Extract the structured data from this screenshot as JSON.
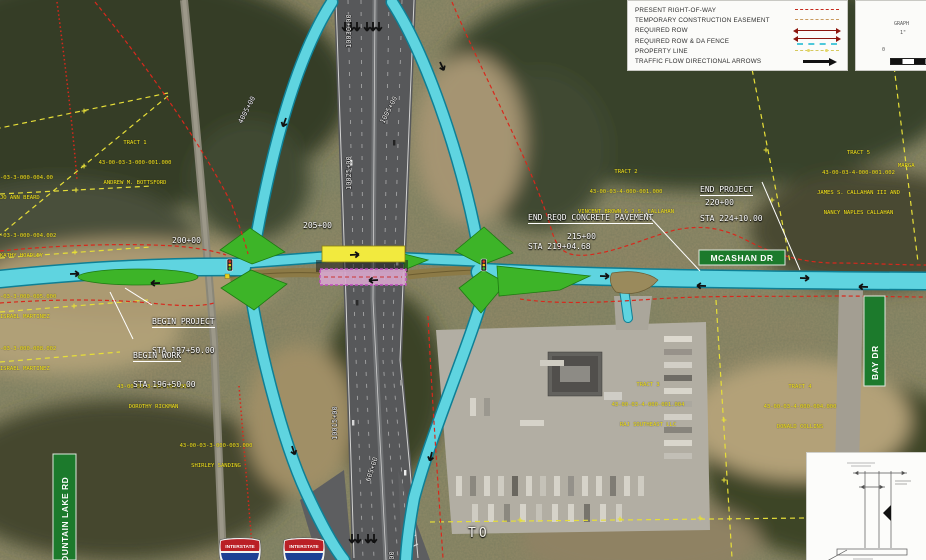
{
  "legend": {
    "items": [
      {
        "label": "PRESENT RIGHT-OF-WAY"
      },
      {
        "label": "TEMPORARY CONSTRUCTION EASEMENT"
      },
      {
        "label": "REQUIRED ROW"
      },
      {
        "label": "REQUIRED ROW & DA FENCE"
      },
      {
        "label": "PROPERTY LINE"
      },
      {
        "label": "TRAFFIC FLOW DIRECTIONAL ARROWS"
      }
    ]
  },
  "graphic_scale": {
    "title_fragment": "GRAPH",
    "ratio_fragment": "1\"",
    "zero_label": "0"
  },
  "annotations": {
    "begin_project_line1": "BEGIN PROJECT",
    "begin_project_line2": "STA 197+50.00",
    "begin_work_line1": "BEGIN WORK",
    "begin_work_line2": "STA 196+50.00",
    "end_reqd_line1": "END REQD CONCRETE PAVEMENT",
    "end_reqd_line2": "STA 219+04.68",
    "end_project_line1": "END PROJECT",
    "end_project_line2": "STA 224+10.00",
    "to_label": "TO"
  },
  "stations": {
    "s200": "200+00",
    "s205": "205+00",
    "s215": "215+00",
    "s220": "220+00",
    "m10030": "10030+00",
    "m10025": "10025+00",
    "m10015": "10015+00",
    "m10010": "10010+00",
    "r4005": "4005+00",
    "r1005": "1005+00",
    "r605": "605+00"
  },
  "signs": {
    "mcashan": "MCASHAN  DR",
    "bay_dr": "BAY  DR",
    "mountain_lake": "MOUNTAIN  LAKE  RD",
    "interstate_shield": "INTERSTATE"
  },
  "tracts": {
    "t1": {
      "l1": "TRACT 1",
      "l2": "43-00-03-3-000-001.000",
      "l3": "ANDREW M. BOTTSFORD"
    },
    "t2": {
      "l1": "TRACT 2",
      "l2": "43-00-03-4-000-001.000",
      "l3": "VINCENT BROWN & J.S. CALLAHAN"
    },
    "t5": {
      "l1": "TRACT 5",
      "l2": "43-00-03-4-000-001.002",
      "l3": "JAMES S. CALLAHAN III AND",
      "l4": "NANCY NAPLES CALLAHAN"
    },
    "t3": {
      "l1": "TRACT 3",
      "l2": "43-00-03-4-000-001.004",
      "l3": "RAJ SOUTHEAST LLC"
    },
    "t4": {
      "l1": "TRACT 4",
      "l2": "43-00-03-4-000-004.000",
      "l3": "DONALD COLLINS"
    },
    "rickman": {
      "l1": "43-00-03-3-000-002.000",
      "l2": "DOROTHY RICKMAN"
    },
    "sanding": {
      "l1": "43-00-03-3-000-003.000",
      "l2": "SHIRLEY SANDING"
    },
    "beard": {
      "l1": "-03-3-000-004.00",
      "l2": "JO ANN BEARD"
    },
    "hoadley": {
      "l1": "-03-3-000-004.002",
      "l2": "KATHY HOADLEY"
    },
    "martinez1": {
      "l1": "-03-3-000-005.000",
      "l2": "ISRAEL MARTINEZ"
    },
    "martinez2": {
      "l1": "-03-3-000-008.002",
      "l2": "ISRAEL MARTINEZ"
    },
    "edge_right": {
      "l1": "MARGA"
    }
  },
  "colors": {
    "proposed_road_cyan": "#5fd4e0",
    "median_island_green": "#3db428",
    "bridge_highlight_yellow": "#f2ea3e",
    "existing_bridge_magenta": "#c84ac8",
    "present_row_red": "#d8281c",
    "required_row_dark_red": "#8c150e",
    "property_line_yellow": "#e6de38",
    "tract_label_yellow": "#f2e41e",
    "guide_sign_green": "#1c7a2c"
  }
}
